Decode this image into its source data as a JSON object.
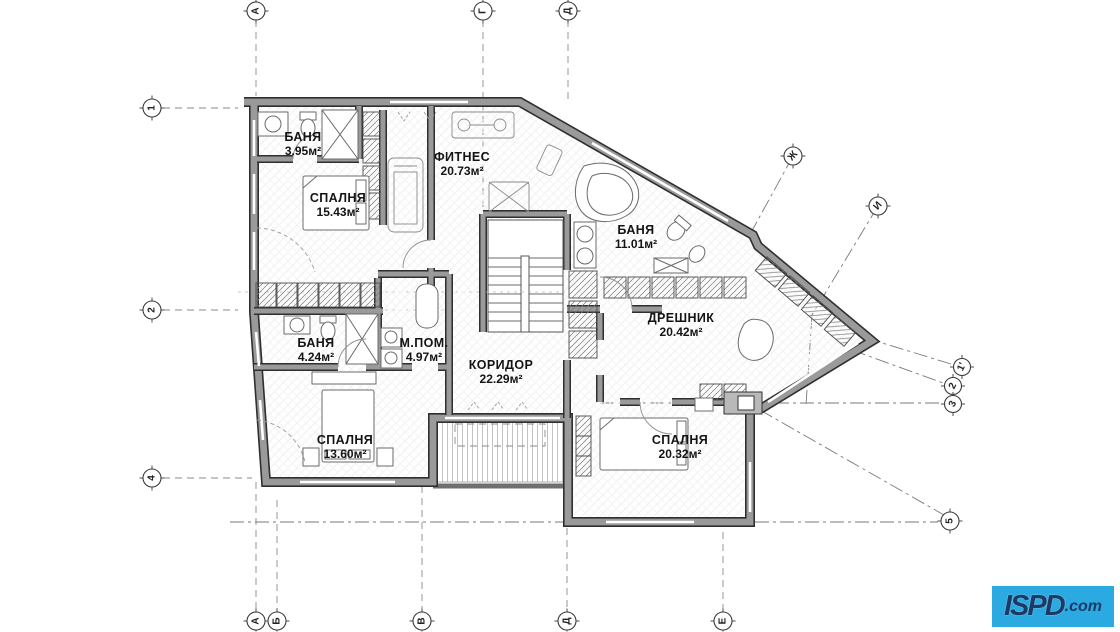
{
  "plan": {
    "rooms": [
      {
        "name": "БАНЯ",
        "area": "3.95м²"
      },
      {
        "name": "ФИТНЕС",
        "area": "20.73м²"
      },
      {
        "name": "СПАЛНЯ",
        "area": "15.43м²"
      },
      {
        "name": "БАНЯ",
        "area": "11.01м²"
      },
      {
        "name": "ДРЕШНИК",
        "area": "20.42м²"
      },
      {
        "name": "БАНЯ",
        "area": "4.24м²"
      },
      {
        "name": "М.ПОМ.",
        "area": "4.97м²"
      },
      {
        "name": "КОРИДОР",
        "area": "22.29м²"
      },
      {
        "name": "СПАЛНЯ",
        "area": "13.60м²"
      },
      {
        "name": "СПАЛНЯ",
        "area": "20.32м²"
      }
    ],
    "axes": {
      "top": [
        "А",
        "Г",
        "Д"
      ],
      "bottom": [
        "А",
        "Б",
        "В",
        "Д",
        "Е"
      ],
      "left": [
        "1",
        "2",
        "4"
      ],
      "right": [
        "5"
      ],
      "diagonal": [
        "Ж",
        "И",
        "1'",
        "2",
        "3"
      ]
    },
    "colors": {
      "wall": "#9a9a9a",
      "wall_edge": "#2f2f2f",
      "reference_line": "#7a7a7a",
      "text": "#141414"
    }
  },
  "logo": {
    "name": "ISPD",
    "suffix": ".com",
    "bg": "#2aaae1",
    "fg": "#1b3b66"
  }
}
